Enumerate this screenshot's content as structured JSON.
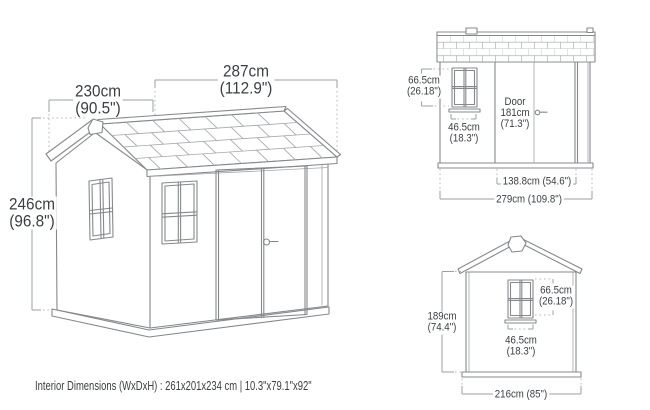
{
  "perspective_view": {
    "width_label": {
      "cm": "287cm",
      "in": "(112.9\")"
    },
    "depth_label": {
      "cm": "230cm",
      "in": "(90.5\")"
    },
    "height_label": {
      "cm": "246cm",
      "in": "(96.8\")"
    }
  },
  "side_view": {
    "window_height": {
      "cm": "66.5cm",
      "in": "(26.18\")"
    },
    "window_width": {
      "cm": "46.5cm",
      "in": "(18.3\")"
    },
    "door": {
      "name": "Door",
      "cm": "181cm",
      "in": "(71.3\")"
    },
    "door_opening_width": "138.8cm (54.6\")",
    "overall_width": "279cm (109.8\")"
  },
  "front_view": {
    "wall_height": {
      "cm": "189cm",
      "in": "(74.4\")"
    },
    "window_height": {
      "cm": "66.5cm",
      "in": "(26.18\")"
    },
    "window_width": {
      "cm": "46.5cm",
      "in": "(18.3\")"
    },
    "overall_width": "216cm (85\")"
  },
  "footer": {
    "interior_dimensions": "Interior Dimensions (WxDxH) : 261x201x234 cm | 10.3\"x79.1\"x92\""
  },
  "colors": {
    "line": "#85898c",
    "line-light": "#a4a8ab",
    "dim": "#9aa0a3",
    "dot": "#b5b9bb",
    "text": "#3a3f42",
    "bg": "#ffffff"
  }
}
